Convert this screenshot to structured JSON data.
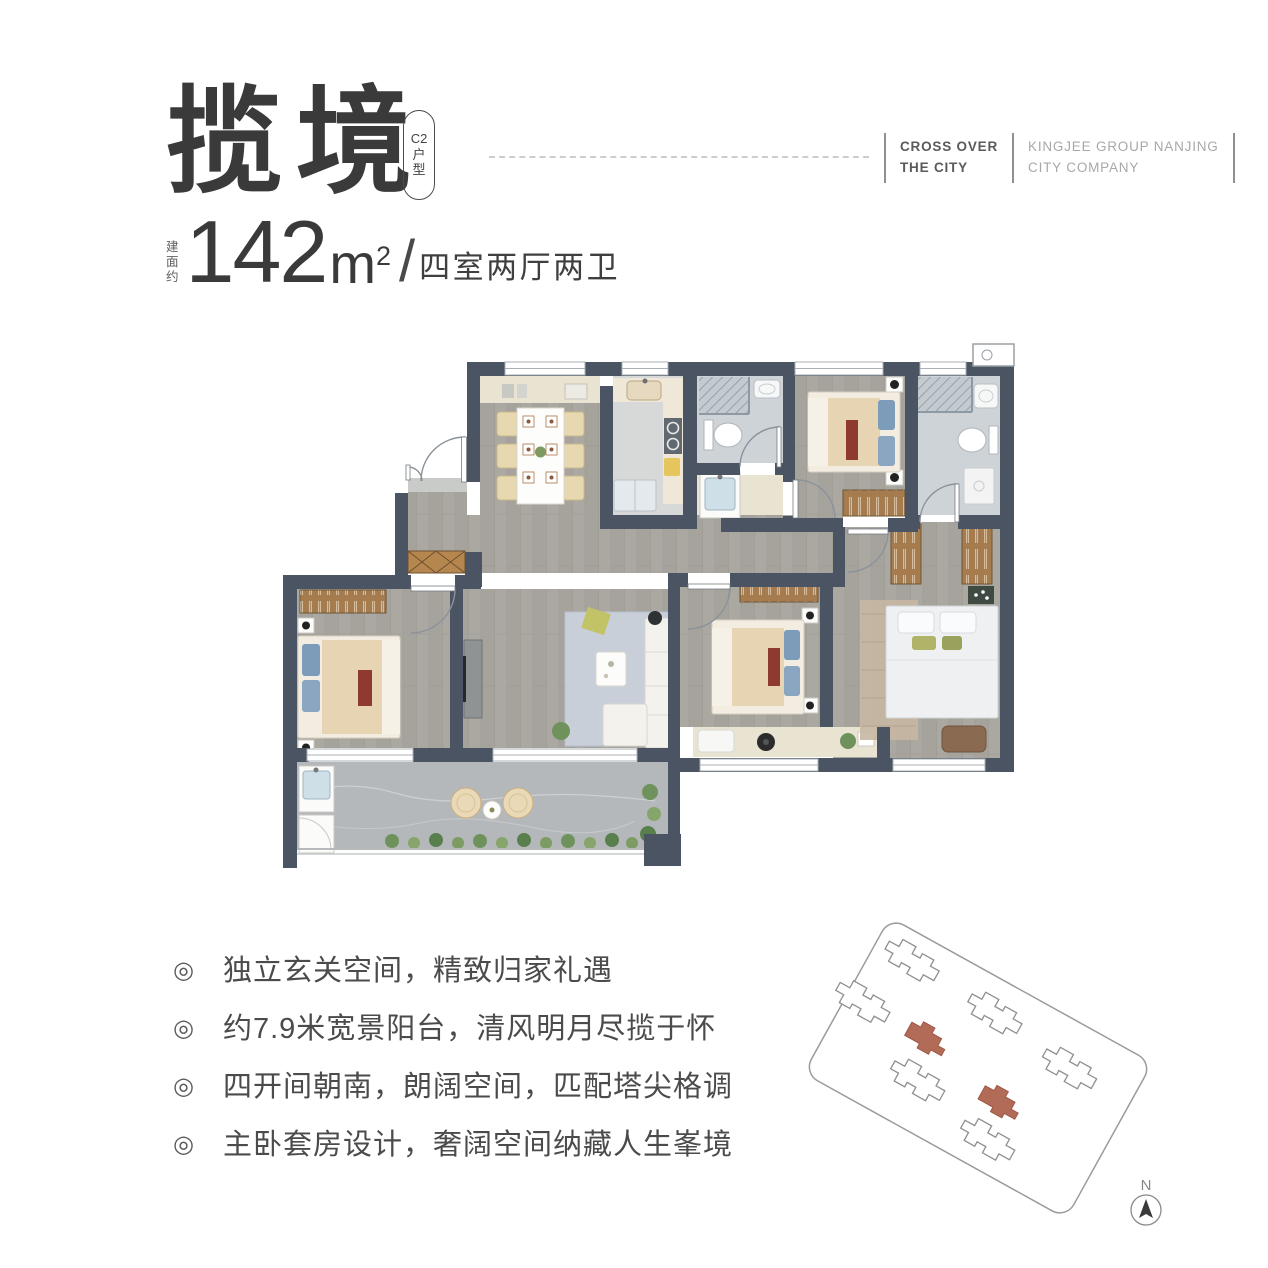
{
  "header": {
    "title": "揽境",
    "type_badge": [
      "C2",
      "户",
      "型"
    ],
    "brand_primary_lines": [
      "CROSS OVER",
      "THE CITY"
    ],
    "brand_secondary_lines": [
      "KINGJEE GROUP NANJING",
      "CITY COMPANY"
    ]
  },
  "spec": {
    "area_prefix_chars": [
      "建",
      "面",
      "约"
    ],
    "area_value": "142",
    "area_unit": "m",
    "area_exponent": "2",
    "separator": "/",
    "layout_text": "四室两厅两卫"
  },
  "features": {
    "marker": "◎",
    "items": [
      "独立玄关空间，精致归家礼遇",
      "约7.9米宽景阳台，清风明月尽揽于怀",
      "四开间朝南，朗阔空间，匹配塔尖格调",
      "主卧套房设计，奢阔空间纳藏人生峯境"
    ]
  },
  "floor_plan": {
    "rooms": [
      "entry",
      "dining",
      "kitchen",
      "bath",
      "laundry",
      "bedroom-2",
      "master-bath",
      "closet",
      "bedroom-3",
      "master-bedroom",
      "living",
      "bedroom-4",
      "balcony",
      "bay-window"
    ],
    "wall_color": "#4a5462",
    "wood_color": "#a6a39d",
    "tile_color": "#e9e3d2",
    "bath_color": "#ced3d7",
    "balcony_color": "#b5b8ba",
    "wardrobe_color": "#a67c4e",
    "bed_color": "#e6d4b2",
    "pillow_color": "#7d9cba",
    "accent_red": "#8e3a30",
    "plant_color": "#6f925d"
  },
  "site_plan": {
    "compass_label": "N",
    "outline_color": "#9a9a9a",
    "building_outline": "#8f8f8f",
    "highlight_color": "#b26b56"
  },
  "colors": {
    "bg": "#ffffff",
    "ink": "#3a3a3a",
    "text": "#4b4b4b",
    "muted": "#a8a8a8",
    "dotted": "#cdcdcd"
  }
}
